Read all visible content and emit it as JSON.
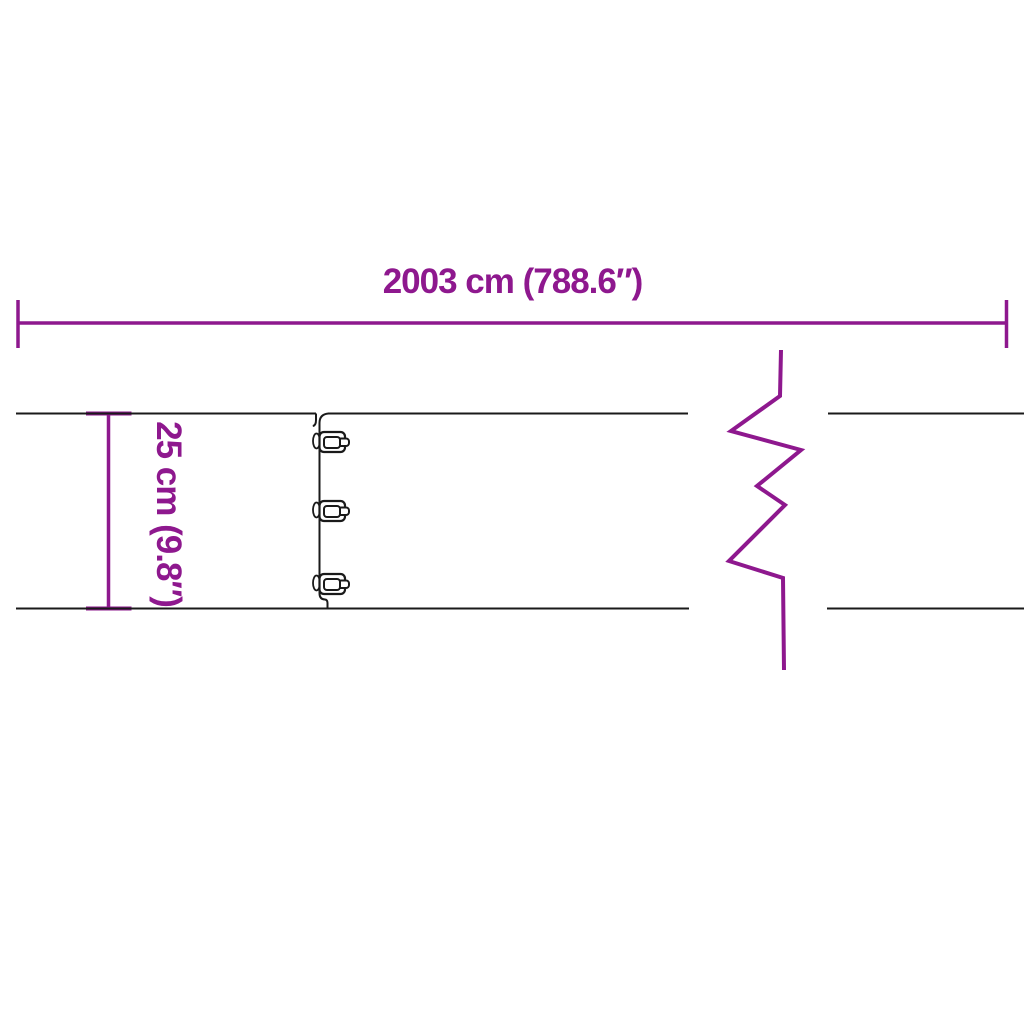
{
  "colors": {
    "accent": "#8E188E",
    "ink": "#1A1A1A",
    "background": "#FFFFFF"
  },
  "labels": {
    "width": "2003 cm (788.6″)",
    "height": "25 cm (9.8″)"
  },
  "diagram": {
    "type": "product-dimension-drawing",
    "clip_count": 3,
    "icons": [
      "width-dimension-line-icon",
      "height-dimension-line-icon",
      "connector-clip-icon",
      "break-zigzag-icon"
    ]
  }
}
